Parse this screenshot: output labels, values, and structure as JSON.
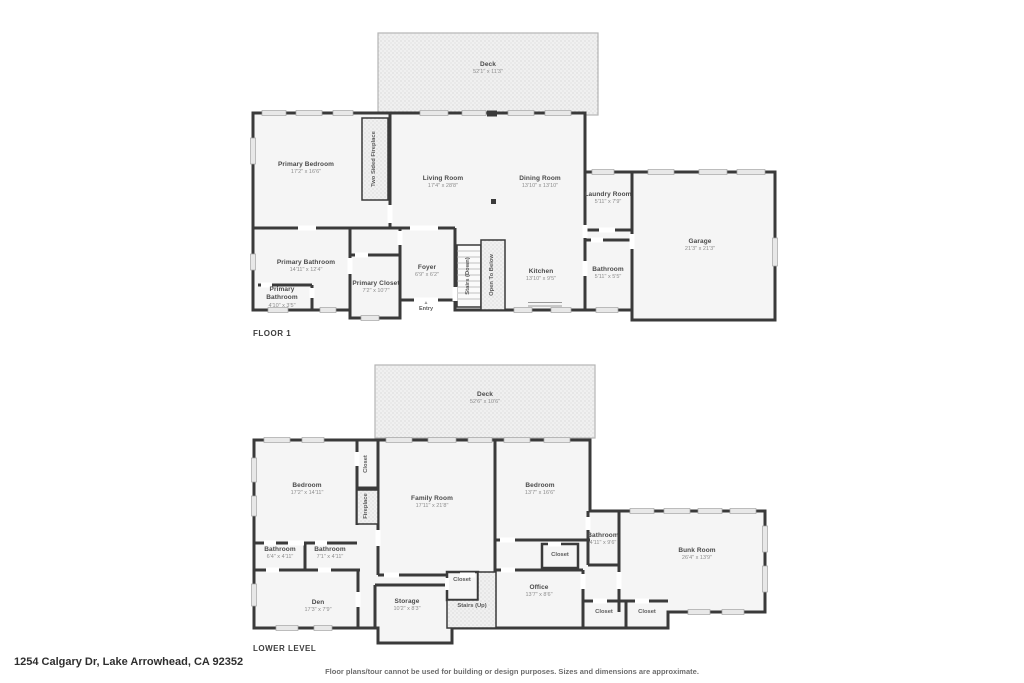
{
  "page": {
    "address": "1254 Calgary Dr, Lake Arrowhead, CA 92352",
    "disclaimer": "Floor plans/tour cannot be used for building or design purposes. Sizes and dimensions are approximate.",
    "colors": {
      "wall": "#3a3a3a",
      "room_fill": "#f5f5f5",
      "texture_fill": "#ececec",
      "label_text": "#4a4a4a",
      "dim_text": "#8d8d8d"
    }
  },
  "floor1": {
    "label": "FLOOR 1",
    "deck": {
      "name": "Deck",
      "dims": "52'1\" x 11'3\""
    },
    "rooms": {
      "primary_bedroom": {
        "name": "Primary Bedroom",
        "dims": "17'2\" x 16'6\""
      },
      "living_room": {
        "name": "Living Room",
        "dims": "17'4\" x 28'8\""
      },
      "dining_room": {
        "name": "Dining Room",
        "dims": "13'10\" x 13'10\""
      },
      "laundry_room": {
        "name": "Laundry Room",
        "dims": "5'11\" x 7'9\""
      },
      "garage": {
        "name": "Garage",
        "dims": "21'3\" x 21'3\""
      },
      "primary_bathroom": {
        "name": "Primary Bathroom",
        "dims": "14'11\" x 12'4\""
      },
      "primary_bathroom_small": {
        "name": "Primary Bathroom",
        "dims": "4'10\" x 3'5\""
      },
      "primary_closet": {
        "name": "Primary Closet",
        "dims": "7'2\" x 10'7\""
      },
      "foyer": {
        "name": "Foyer",
        "dims": "6'9\" x 6'2\""
      },
      "kitchen": {
        "name": "Kitchen",
        "dims": "13'10\" x 9'5\""
      },
      "bathroom": {
        "name": "Bathroom",
        "dims": "5'11\" x 5'5\""
      }
    },
    "features": {
      "fireplace": "Two Sided Fireplace",
      "stairs": "Stairs (Down)",
      "open_below": "Open To Below",
      "entry": "Entry"
    }
  },
  "lower": {
    "label": "LOWER LEVEL",
    "deck": {
      "name": "Deck",
      "dims": "52'6\" x 10'6\""
    },
    "rooms": {
      "bedroom_left": {
        "name": "Bedroom",
        "dims": "17'2\" x 14'11\""
      },
      "family_room": {
        "name": "Family Room",
        "dims": "17'11\" x 21'8\""
      },
      "bedroom_right": {
        "name": "Bedroom",
        "dims": "13'7\" x 16'6\""
      },
      "bathroom_left": {
        "name": "Bathroom",
        "dims": "6'4\" x 4'11\""
      },
      "bathroom_mid": {
        "name": "Bathroom",
        "dims": "7'1\" x 4'11\""
      },
      "bathroom_right": {
        "name": "Bathroom",
        "dims": "4'11\" x 9'6\""
      },
      "bunk_room": {
        "name": "Bunk Room",
        "dims": "26'4\" x 13'9\""
      },
      "den": {
        "name": "Den",
        "dims": "17'3\" x 7'9\""
      },
      "storage": {
        "name": "Storage",
        "dims": "10'2\" x 8'3\""
      },
      "office": {
        "name": "Office",
        "dims": "13'7\" x 8'6\""
      }
    },
    "features": {
      "closet_strip": "Closet",
      "fireplace": "Fireplace",
      "closet_bedroom": "Closet",
      "closet_hall": "Closet",
      "stairs": "Stairs (Up)",
      "closet_office_1": "Closet",
      "closet_office_2": "Closet"
    }
  }
}
